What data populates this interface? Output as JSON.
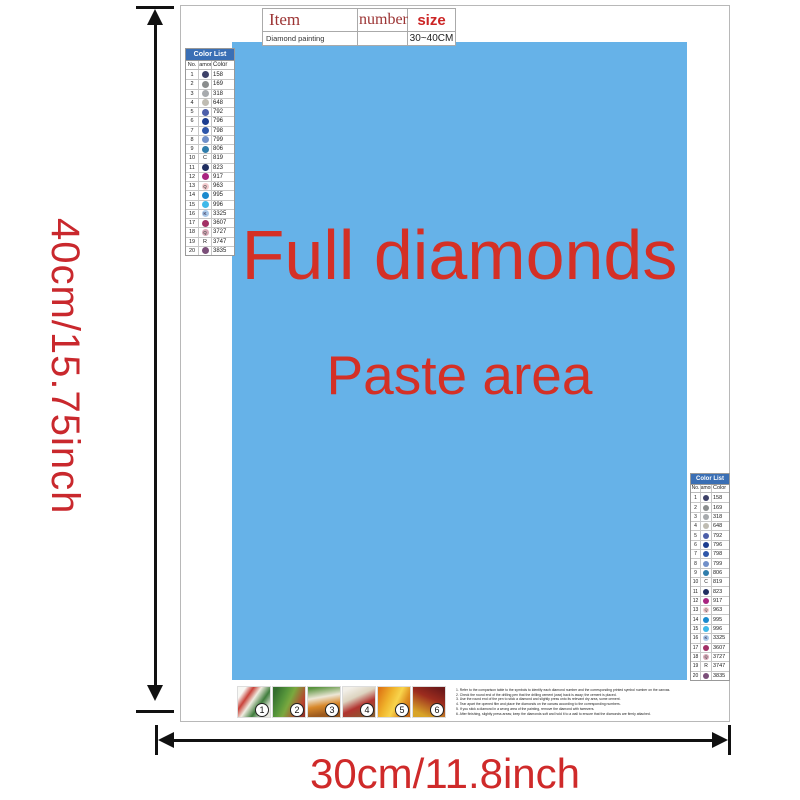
{
  "window": {
    "background": "#ffffff"
  },
  "dimension_labels": {
    "height": "40cm/15.75inch",
    "width": "30cm/11.8inch",
    "label_color": "#cf2a2a"
  },
  "item_table": {
    "headers": [
      "Item",
      "number",
      "size"
    ],
    "row": [
      "Diamond painting",
      "",
      "30~40CM"
    ]
  },
  "paste_area": {
    "background": "#66b2e8",
    "text_color": "#d43026",
    "line1": "Full diamonds",
    "line2": "Paste area"
  },
  "color_list": {
    "title": "Color List",
    "header_bg": "#3a6fb5",
    "columns": [
      "No.",
      "Diamond",
      "Color"
    ],
    "rows": [
      {
        "no": "1",
        "symbol": "",
        "code": "158",
        "circle": "#3d4168",
        "letter_color": "#ffffff"
      },
      {
        "no": "2",
        "symbol": "",
        "code": "169",
        "circle": "#8a8d8d",
        "letter_color": "#ffffff"
      },
      {
        "no": "3",
        "symbol": "",
        "code": "318",
        "circle": "#a7aaad",
        "letter_color": "#ffffff"
      },
      {
        "no": "4",
        "symbol": "",
        "code": "648",
        "circle": "#bfbcb2",
        "letter_color": "#555555"
      },
      {
        "no": "5",
        "symbol": "",
        "code": "792",
        "circle": "#4d5fa9",
        "letter_color": "#ffffff"
      },
      {
        "no": "6",
        "symbol": "",
        "code": "796",
        "circle": "#1c3d8f",
        "letter_color": "#ffffff"
      },
      {
        "no": "7",
        "symbol": "",
        "code": "798",
        "circle": "#2e56a9",
        "letter_color": "#ffffff"
      },
      {
        "no": "8",
        "symbol": "",
        "code": "799",
        "circle": "#7190c9",
        "letter_color": "#ffffff"
      },
      {
        "no": "9",
        "symbol": "",
        "code": "806",
        "circle": "#2f7dab",
        "letter_color": "#ffffff"
      },
      {
        "no": "10",
        "symbol": "C",
        "code": "819",
        "circle": "",
        "letter_color": "#222222"
      },
      {
        "no": "11",
        "symbol": "",
        "code": "823",
        "circle": "#202e60",
        "letter_color": "#ffffff"
      },
      {
        "no": "12",
        "symbol": "",
        "code": "917",
        "circle": "#a92480",
        "letter_color": "#ffffff"
      },
      {
        "no": "13",
        "symbol": "Q",
        "code": "963",
        "circle": "#f4cacd",
        "letter_color": "#555555"
      },
      {
        "no": "14",
        "symbol": "",
        "code": "995",
        "circle": "#1a8ace",
        "letter_color": "#ffffff"
      },
      {
        "no": "15",
        "symbol": "",
        "code": "996",
        "circle": "#3fb9e9",
        "letter_color": "#ffffff"
      },
      {
        "no": "16",
        "symbol": "K",
        "code": "3325",
        "circle": "#aac9e9",
        "letter_color": "#444466"
      },
      {
        "no": "17",
        "symbol": "",
        "code": "3607",
        "circle": "#a23065",
        "letter_color": "#ffffff"
      },
      {
        "no": "18",
        "symbol": "Q",
        "code": "3727",
        "circle": "#d9aab9",
        "letter_color": "#555555"
      },
      {
        "no": "19",
        "symbol": "R",
        "code": "3747",
        "circle": "",
        "letter_color": "#222222"
      },
      {
        "no": "20",
        "symbol": "",
        "code": "3835",
        "circle": "#7b4f79",
        "letter_color": "#ffffff"
      }
    ]
  },
  "steps": {
    "items": [
      {
        "num": "1"
      },
      {
        "num": "2"
      },
      {
        "num": "3"
      },
      {
        "num": "4"
      },
      {
        "num": "5"
      },
      {
        "num": "6"
      }
    ]
  },
  "instructions": {
    "lines": [
      "1. Refer to the comparison table to the symbols to identify each diamond number and the corresponding printed symbol number on the canvas.",
      "2. Check the round end of the drilling pen that the drilling cement (wax) back is away; the cement is placed.",
      "3. Use the round end of the pen to stick a diamond and slightly press onto its relevant dry area, some cement.",
      "4. Tear apart the opened film and place the diamonds on the canvas according to the corresponding numbers.",
      "5. If you stick a diamond in a wrong area of the painting, remove the diamond with tweezers.",
      "6. After finishing, slightly press areas; keep the diamonds soft and hold it to a wall to ensure that the diamonds are firmly attached."
    ]
  }
}
